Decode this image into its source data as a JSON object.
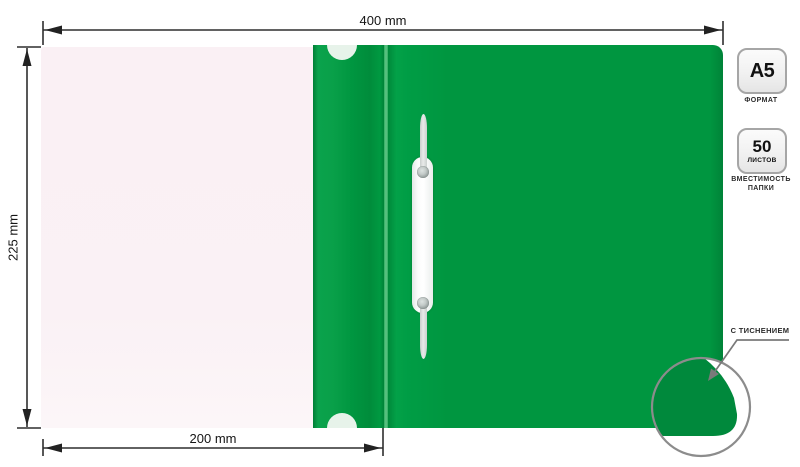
{
  "dimensions": {
    "total_width": "400 mm",
    "height": "225 mm",
    "cover_width": "200 mm"
  },
  "badges": {
    "format": {
      "value": "A5",
      "caption": "ФОРМАТ"
    },
    "capacity": {
      "value": "50",
      "unit": "ЛИСТОВ",
      "caption": "ВМЕСТИМОСТЬ ПАПКИ"
    }
  },
  "callout": {
    "label": "С ТИСНЕНИЕМ"
  },
  "colors": {
    "folder_green": "#009640",
    "emboss_green": "#00893C",
    "cover_tint": "#FAF1F5",
    "annotation_ink": "#222222",
    "callout_gray": "#7A7A7A"
  }
}
